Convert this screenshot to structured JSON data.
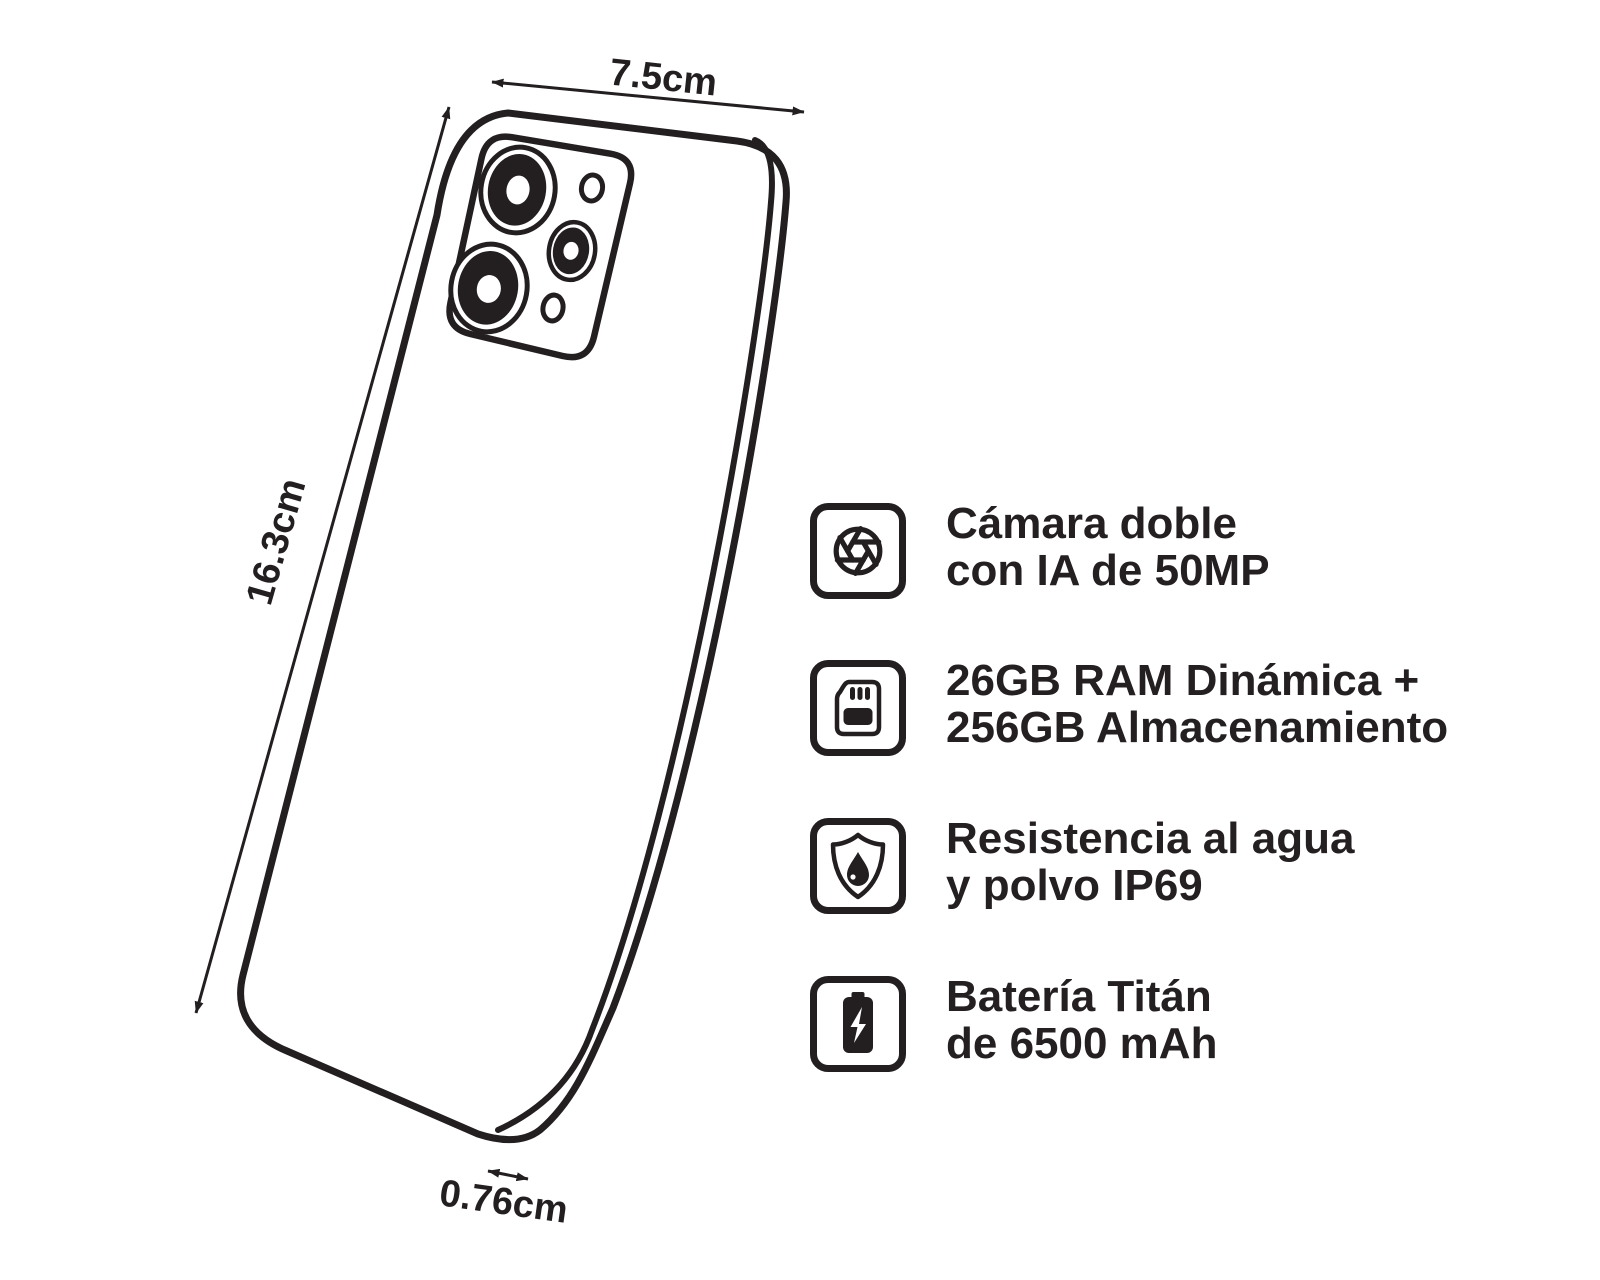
{
  "colors": {
    "ink": "#231f20",
    "background": "#ffffff"
  },
  "diagram": {
    "subject": "smartphone-back-three-quarter-line-art",
    "dimensions": {
      "width_label": "7.5cm",
      "height_label": "16.3cm",
      "depth_label": "0.76cm"
    }
  },
  "features": [
    {
      "icon": "aperture-icon",
      "line1": "Cámara doble",
      "line2": "con IA de 50MP"
    },
    {
      "icon": "sd-card-icon",
      "line1": "26GB RAM Dinámica +",
      "line2": "256GB Almacenamiento"
    },
    {
      "icon": "shield-water-icon",
      "line1": "Resistencia al agua",
      "line2": "y polvo IP69"
    },
    {
      "icon": "battery-icon",
      "line1": "Batería Titán",
      "line2": "de 6500 mAh"
    }
  ]
}
